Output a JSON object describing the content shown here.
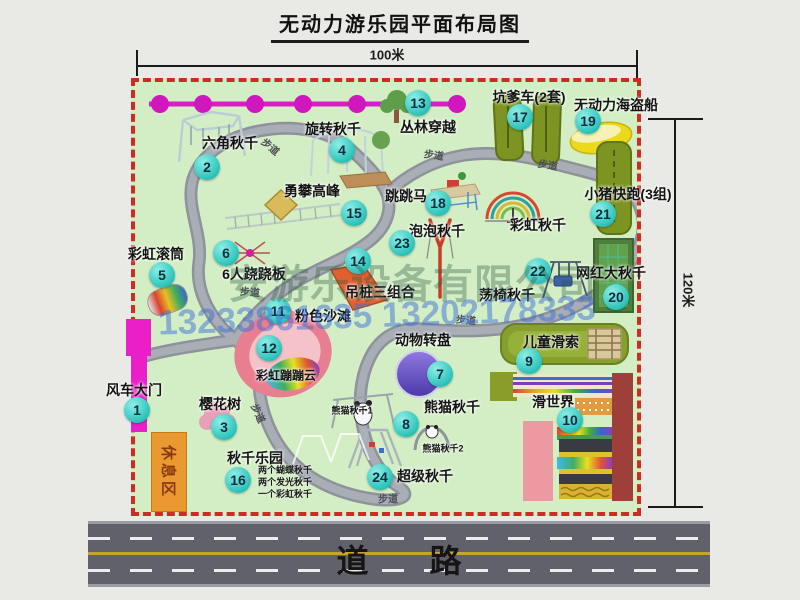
{
  "title": "无动力游乐园平面布局图",
  "dimensions": {
    "width_label": "100米",
    "height_label": "120米"
  },
  "road": {
    "label": "道 路"
  },
  "rest_area": {
    "label": "休息区"
  },
  "watermark": {
    "company": "安游乐设备有限公司",
    "phone": "13233861635 13202178333"
  },
  "colors": {
    "map_green": "#d3eec5",
    "border_red": "#ce2b23",
    "marker_teal": "#2cc3bb",
    "gate_magenta": "#ea1fc8",
    "road_gray": "#61616b",
    "rest_orange": "#e9992f"
  },
  "markers": [
    {
      "num": 1,
      "label": "风车大门",
      "lx": 134,
      "ly": 390,
      "cx": 137,
      "cy": 410
    },
    {
      "num": 2,
      "label": "六角秋千",
      "lx": 230,
      "ly": 143,
      "cx": 207,
      "cy": 167
    },
    {
      "num": 3,
      "label": "樱花树",
      "lx": 220,
      "ly": 404,
      "cx": 224,
      "cy": 427
    },
    {
      "num": 4,
      "label": "旋转秋千",
      "lx": 333,
      "ly": 129,
      "cx": 342,
      "cy": 150
    },
    {
      "num": 5,
      "label": "彩虹滚筒",
      "lx": 156,
      "ly": 254,
      "cx": 162,
      "cy": 275
    },
    {
      "num": 6,
      "label": "6人跷跷板",
      "lx": 254,
      "ly": 274,
      "cx": 226,
      "cy": 253
    },
    {
      "num": 7,
      "label": "动物转盘",
      "lx": 423,
      "ly": 340,
      "cx": 440,
      "cy": 374
    },
    {
      "num": 8,
      "label": "熊猫秋千",
      "lx": 452,
      "ly": 407,
      "cx": 406,
      "cy": 424
    },
    {
      "num": 9,
      "label": "儿童滑索",
      "lx": 551,
      "ly": 342,
      "cx": 529,
      "cy": 361
    },
    {
      "num": 10,
      "label": "滑世界",
      "lx": 553,
      "ly": 402,
      "cx": 570,
      "cy": 420
    },
    {
      "num": 11,
      "label": "粉色沙滩",
      "lx": 323,
      "ly": 316,
      "cx": 278,
      "cy": 311
    },
    {
      "num": 12,
      "label": "彩虹蹦蹦云",
      "ls": 12,
      "lx": 286,
      "ly": 375,
      "cx": 269,
      "cy": 348
    },
    {
      "num": 13,
      "label": "丛林穿越",
      "lx": 428,
      "ly": 127,
      "cx": 418,
      "cy": 103
    },
    {
      "num": 14,
      "label": "吊桩三组合",
      "lx": 380,
      "ly": 292,
      "cx": 358,
      "cy": 261
    },
    {
      "num": 15,
      "label": "勇攀高峰",
      "lx": 312,
      "ly": 191,
      "cx": 354,
      "cy": 213
    },
    {
      "num": 16,
      "label": "秋千乐园",
      "lx": 255,
      "ly": 458,
      "cx": 238,
      "cy": 480,
      "sub": [
        "两个蝴蝶秋千",
        "两个发光秋千",
        "一个彩虹秋千"
      ],
      "sub_x": 258,
      "sub_y": 464
    },
    {
      "num": 17,
      "label": "坑爹车(2套)",
      "lx": 529,
      "ly": 97,
      "cx": 520,
      "cy": 117
    },
    {
      "num": 18,
      "label": "跳跳马",
      "lx": 406,
      "ly": 196,
      "cx": 438,
      "cy": 203
    },
    {
      "num": 19,
      "label": "无动力海盗船",
      "lx": 616,
      "ly": 105,
      "cx": 588,
      "cy": 121
    },
    {
      "num": 20,
      "label": "网红大秋千",
      "lx": 611,
      "ly": 273,
      "cx": 616,
      "cy": 297
    },
    {
      "num": 21,
      "label": "小猪快跑(3组)",
      "lx": 628,
      "ly": 194,
      "cx": 603,
      "cy": 214
    },
    {
      "num": 22,
      "label": "荡椅秋千",
      "lx": 507,
      "ly": 295,
      "cx": 538,
      "cy": 271
    },
    {
      "num": 23,
      "label": "泡泡秋千",
      "lx": 437,
      "ly": 231,
      "cx": 402,
      "cy": 243
    },
    {
      "num": 24,
      "label": "超级秋千",
      "lx": 425,
      "ly": 476,
      "cx": 380,
      "cy": 477
    }
  ],
  "extra_labels": [
    {
      "text": "彩虹秋千",
      "x": 538,
      "y": 225,
      "size": 14
    },
    {
      "text": "熊猫秋千1",
      "x": 352,
      "y": 410,
      "size": 9
    },
    {
      "text": "熊猫秋千2",
      "x": 443,
      "y": 448,
      "size": 9
    }
  ],
  "path_labels": [
    {
      "text": "步道",
      "x": 271,
      "y": 146,
      "rot": 40
    },
    {
      "text": "步道",
      "x": 434,
      "y": 154,
      "rot": 8
    },
    {
      "text": "步道",
      "x": 548,
      "y": 164,
      "rot": 10
    },
    {
      "text": "步道",
      "x": 250,
      "y": 291,
      "rot": 5
    },
    {
      "text": "步道",
      "x": 466,
      "y": 319,
      "rot": 5
    },
    {
      "text": "步道",
      "x": 259,
      "y": 413,
      "rot": 65
    },
    {
      "text": "步道",
      "x": 388,
      "y": 498,
      "rot": 0
    }
  ]
}
